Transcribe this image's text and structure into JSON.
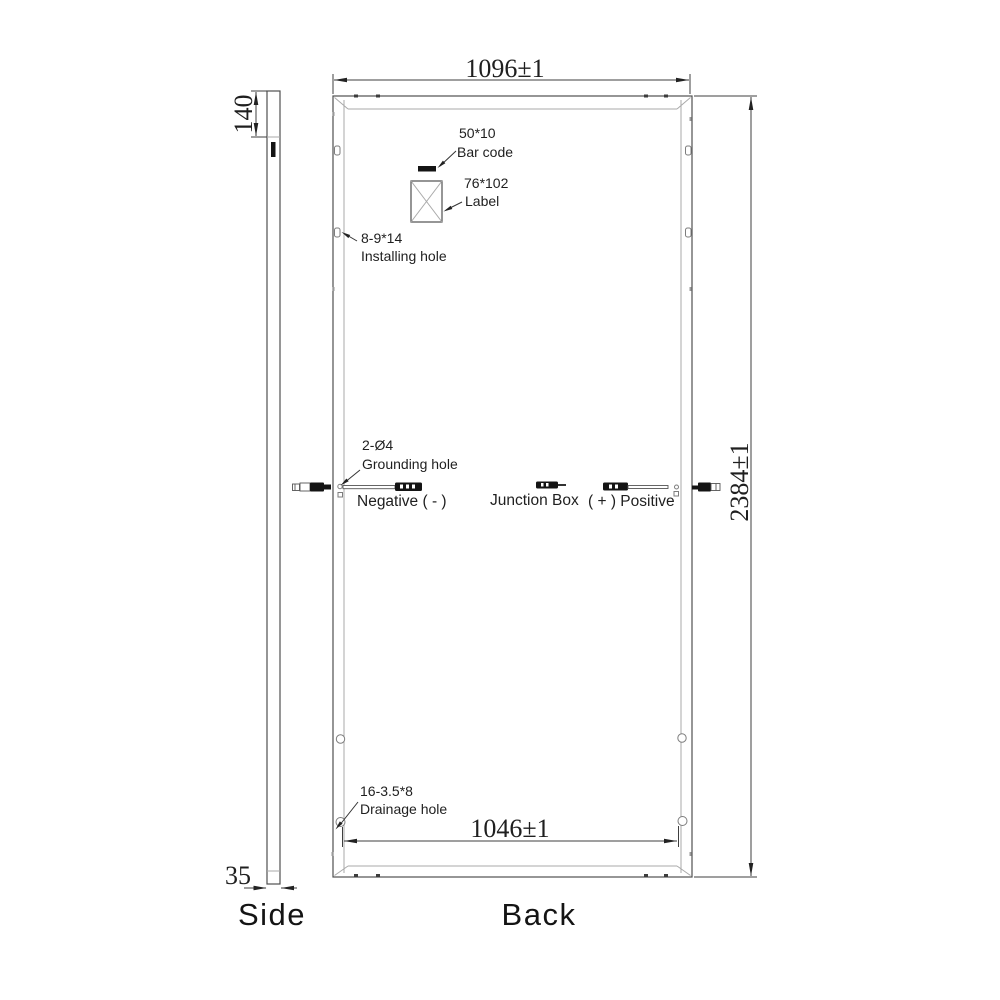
{
  "colors": {
    "background": "#ffffff",
    "main_line": "#4f4f4f",
    "inner_line": "#a9a9a9",
    "text": "#1f1f1f",
    "dark_fill": "#141414"
  },
  "side_view": {
    "label": "Side",
    "top_offset_dim": "140",
    "thickness_dim": "35"
  },
  "back_view": {
    "label": "Back",
    "width_dim": "1096±1",
    "height_dim": "2384±1",
    "mount_width_dim": "1046±1"
  },
  "callouts": {
    "barcode_size": "50*10",
    "barcode_name": "Bar code",
    "label_size": "76*102",
    "label_name": "Label",
    "installing_size": "8-9*14",
    "installing_name": "Installing hole",
    "grounding_size": "2-Ø4",
    "grounding_name": "Grounding hole",
    "drainage_size": "16-3.5*8",
    "drainage_name": "Drainage hole"
  },
  "junction": {
    "negative": "Negative ( - )",
    "box": "Junction Box",
    "positive": "( + ) Positive"
  }
}
